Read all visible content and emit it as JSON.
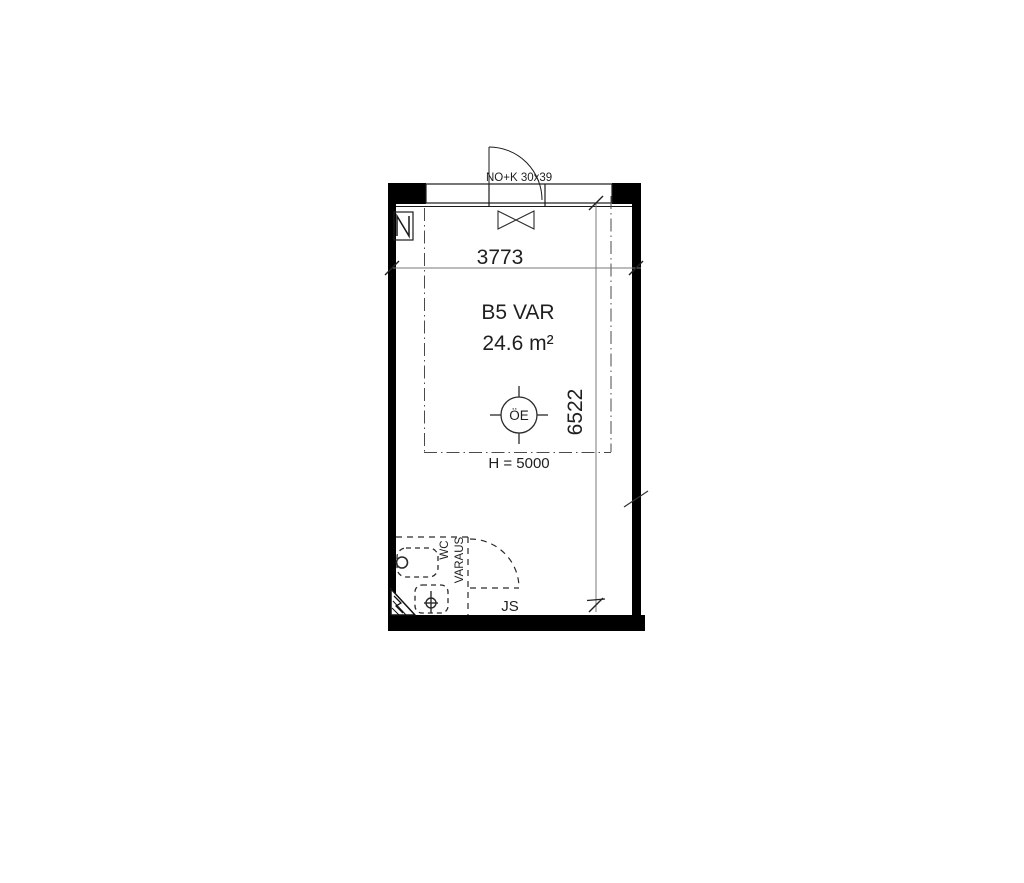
{
  "labels": {
    "door": "NO+K 30x39",
    "room_name": "B5 VAR",
    "room_area": "24.6 m²",
    "height": "H = 5000",
    "fixture": "ÖE",
    "wc": "WC",
    "reservation": "VARAUS",
    "js": "JS"
  },
  "dimensions": {
    "top_width_mm": "3773",
    "right_height_mm": "6522"
  },
  "colors": {
    "wall_fill": "#000000",
    "line": "#1a1a1a",
    "dimension_line": "#7a7a7a",
    "centerline": "#4a4a4a",
    "text": "#1f1f1f",
    "background": "#ffffff"
  }
}
